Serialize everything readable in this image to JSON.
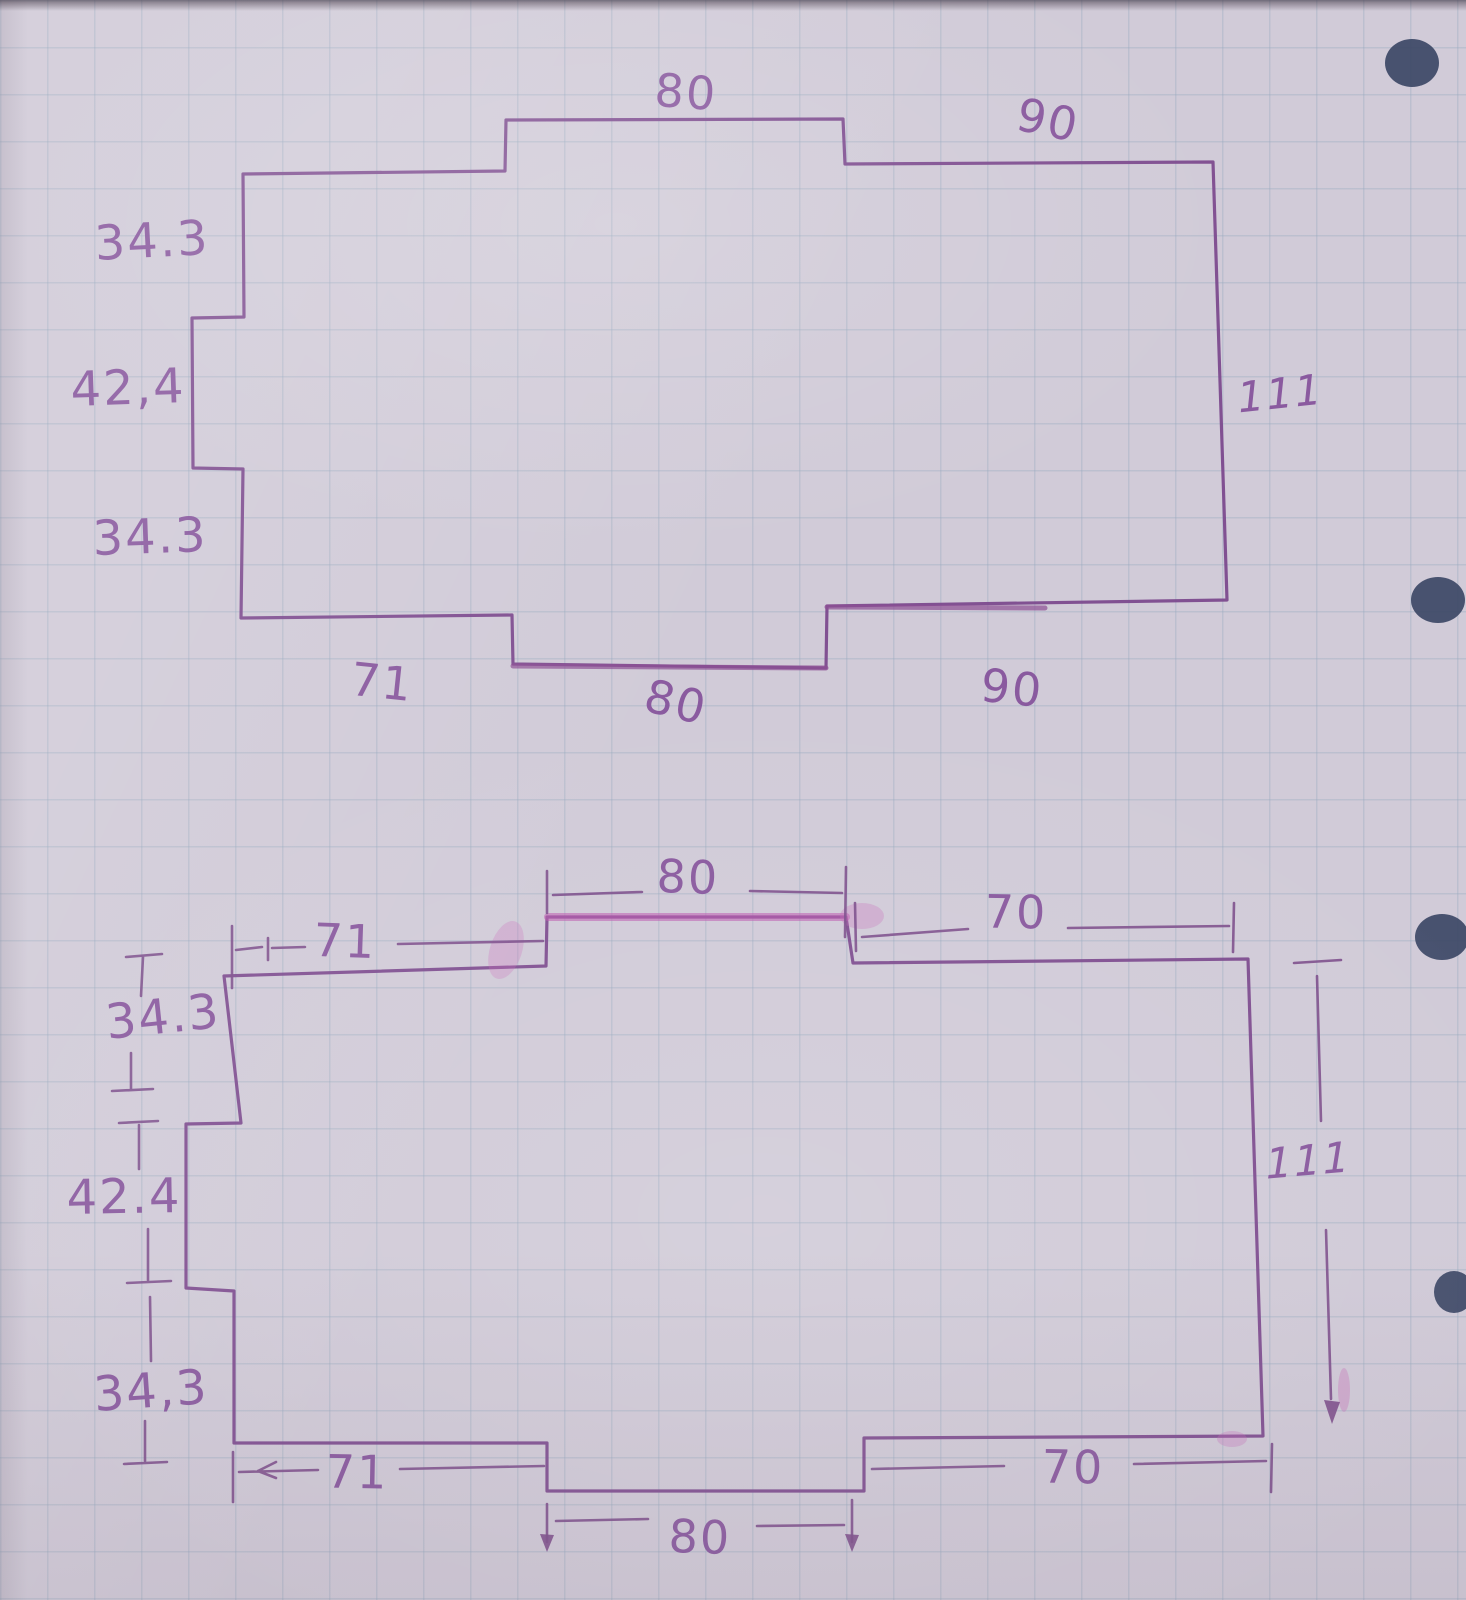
{
  "paper": {
    "type": "hand-drawn floor plan sketch on squared notebook paper",
    "ink_color": "#8a5796",
    "highlight_color": "#c05fae",
    "grid_color": "#94a8be",
    "paper_color": "#d1cbd8",
    "hole_color": "#3d4866"
  },
  "top_diagram": {
    "description": "plain outline sketch with dimension numbers",
    "labels": {
      "top_80": "80",
      "top_90": "90",
      "left_34_upper": "34.3",
      "left_42": "42,4",
      "left_34_lower": "34.3",
      "bottom_71": "71",
      "bottom_80": "80",
      "bottom_90": "90",
      "right_111": "111"
    }
  },
  "bottom_diagram": {
    "description": "same outline redrawn with dimension lines and ticks",
    "labels": {
      "top_80": "80",
      "top_71": "71",
      "top_70": "70",
      "left_34_upper": "34.3",
      "left_42": "42.4",
      "left_34_lower": "34,3",
      "right_111": "111",
      "bottom_71": "71",
      "bottom_70": "70",
      "bottom_80": "80"
    }
  }
}
